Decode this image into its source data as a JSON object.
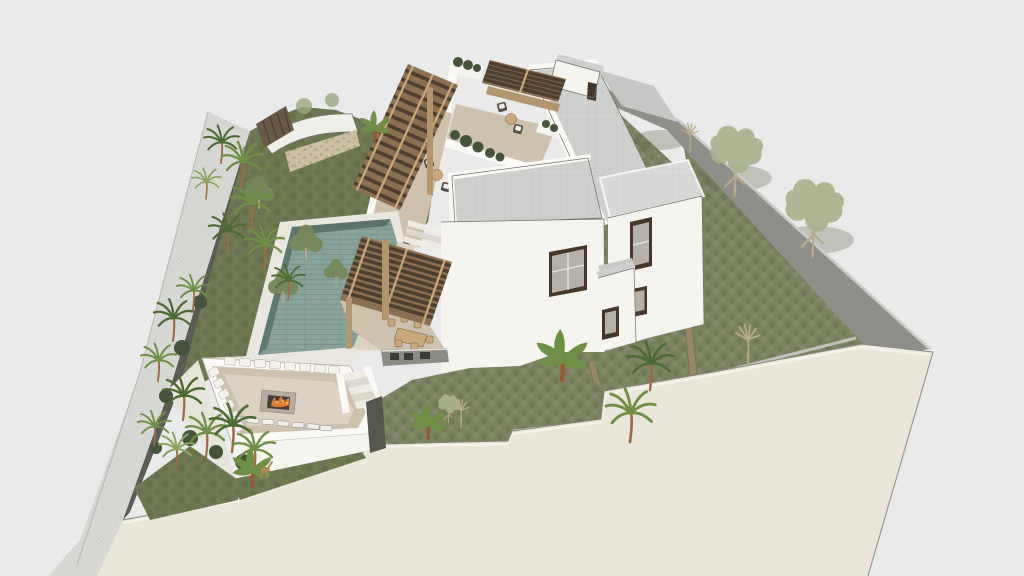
{
  "meta": {
    "type": "3d-architectural-render",
    "style": "sketchup-like aerial axonometric",
    "width_px": 1024,
    "height_px": 576
  },
  "scene": {
    "description": "Aerial 3D render of a modern hillside villa on a walled corner plot with pool, pergolas, sunken fire-pit lounge and tropical landscaping",
    "site": "hillside corner plot villa",
    "buildings": [
      {
        "name": "main-villa-block",
        "features": [
          "flat gray roof",
          "white walls",
          "dark framed window"
        ]
      },
      {
        "name": "right-wing",
        "features": [
          "flat roof",
          "two dark framed windows",
          "small balcony"
        ]
      },
      {
        "name": "rear-long-block",
        "features": [
          "long flat gray roof",
          "white parapet"
        ]
      },
      {
        "name": "lower-terrace-block",
        "features": [
          "rooftop sunken lounge"
        ]
      },
      {
        "name": "top-rear-cube",
        "features": [
          "white parapet",
          "narrow dark window"
        ]
      }
    ],
    "amenities": [
      {
        "name": "swimming-pool",
        "finish": "teal tiled lap pool"
      },
      {
        "name": "sunken-lounge",
        "details": "U-shaped sofa with white pillows around a fire pit"
      },
      {
        "name": "fire-pit",
        "state": "lit"
      },
      {
        "name": "outdoor-dining",
        "details": "timber table with chairs under slatted pergola"
      },
      {
        "name": "outdoor-kitchen",
        "details": "dark counter with appliances"
      },
      {
        "name": "pergola-walkway",
        "details": "timber slat roof over stepped walkway"
      },
      {
        "name": "roof-terrace-seating-upper",
        "details": "two wicker chairs with round table"
      },
      {
        "name": "roof-terrace-seating-lower",
        "details": "two wicker chairs with round table"
      },
      {
        "name": "sun-loungers",
        "count": 7
      }
    ],
    "landscape": [
      "palm trees",
      "banana plants",
      "pale cutout trees",
      "bare sapling trees",
      "sloped lawn",
      "columnar cacti",
      "orange flowering plant",
      "rubble stone wall",
      "timber slat screen",
      "perimeter walls",
      "street with sidewalk",
      "deer figure"
    ]
  },
  "palette": {
    "bg": "#eaeaea",
    "street": "#d8d8d4",
    "streetDot": "#c4c4c0",
    "wallDark": "#5c5c54",
    "wallMid": "#8f8f89",
    "wallLight": "#cdcdc7",
    "grassSlope": "#6d7852",
    "grassLawn": "#7a8260",
    "grassDark": "#5f6848",
    "grassLight": "#8b9472",
    "creamWall": "#eae6d9",
    "creamEdge": "#f5f2e9",
    "whiteWall": "#f6f4ee",
    "whiteShade": "#e7e4da",
    "parapet": "#fbfaf6",
    "roofGray": "#ced1ce",
    "roofGrid": "#bfc2bf",
    "deck": "#cec2ae",
    "deckLight": "#dcd3c2",
    "coping": "#e9e7df",
    "stone": "#cdbfa6",
    "wood": "#6b5947",
    "pergolaTile": "#4e3e2f",
    "pergolaBeam": "#c8a878",
    "pergolaBase": "#b3966c",
    "poolWater": "#87a39a",
    "poolStripe": "#7a968d",
    "poolDark": "#5a746c",
    "pillow": "#f4f2ec",
    "pillowShade": "#b9b4a8",
    "fireBox": "#b5ada0",
    "fireInner": "#453f38",
    "flame": "#dd7c35",
    "flameLight": "#f0a85a",
    "furnDark": "#57524a",
    "furnTan": "#c9a87c",
    "cushion": "#f0eee8",
    "windowFrame": "#473728",
    "windowGlass": "#b5b1a8",
    "mullion": "#e8e6e0",
    "kitchen": "#8c8c84",
    "applianceDark": "#3a3a36",
    "grayStrip": "#c2c2bc",
    "edgeLine": "#6e6e68",
    "palm": "#6f8f46",
    "palmDark": "#4c6b33",
    "palmLight": "#8aa55c",
    "trunk": "#9c6a42",
    "trunkPale": "#b7a98c",
    "cutout": "#a9b28c",
    "shrub": "#45543a",
    "cactus": "#2c3a24",
    "flower": "#c86a3a"
  }
}
